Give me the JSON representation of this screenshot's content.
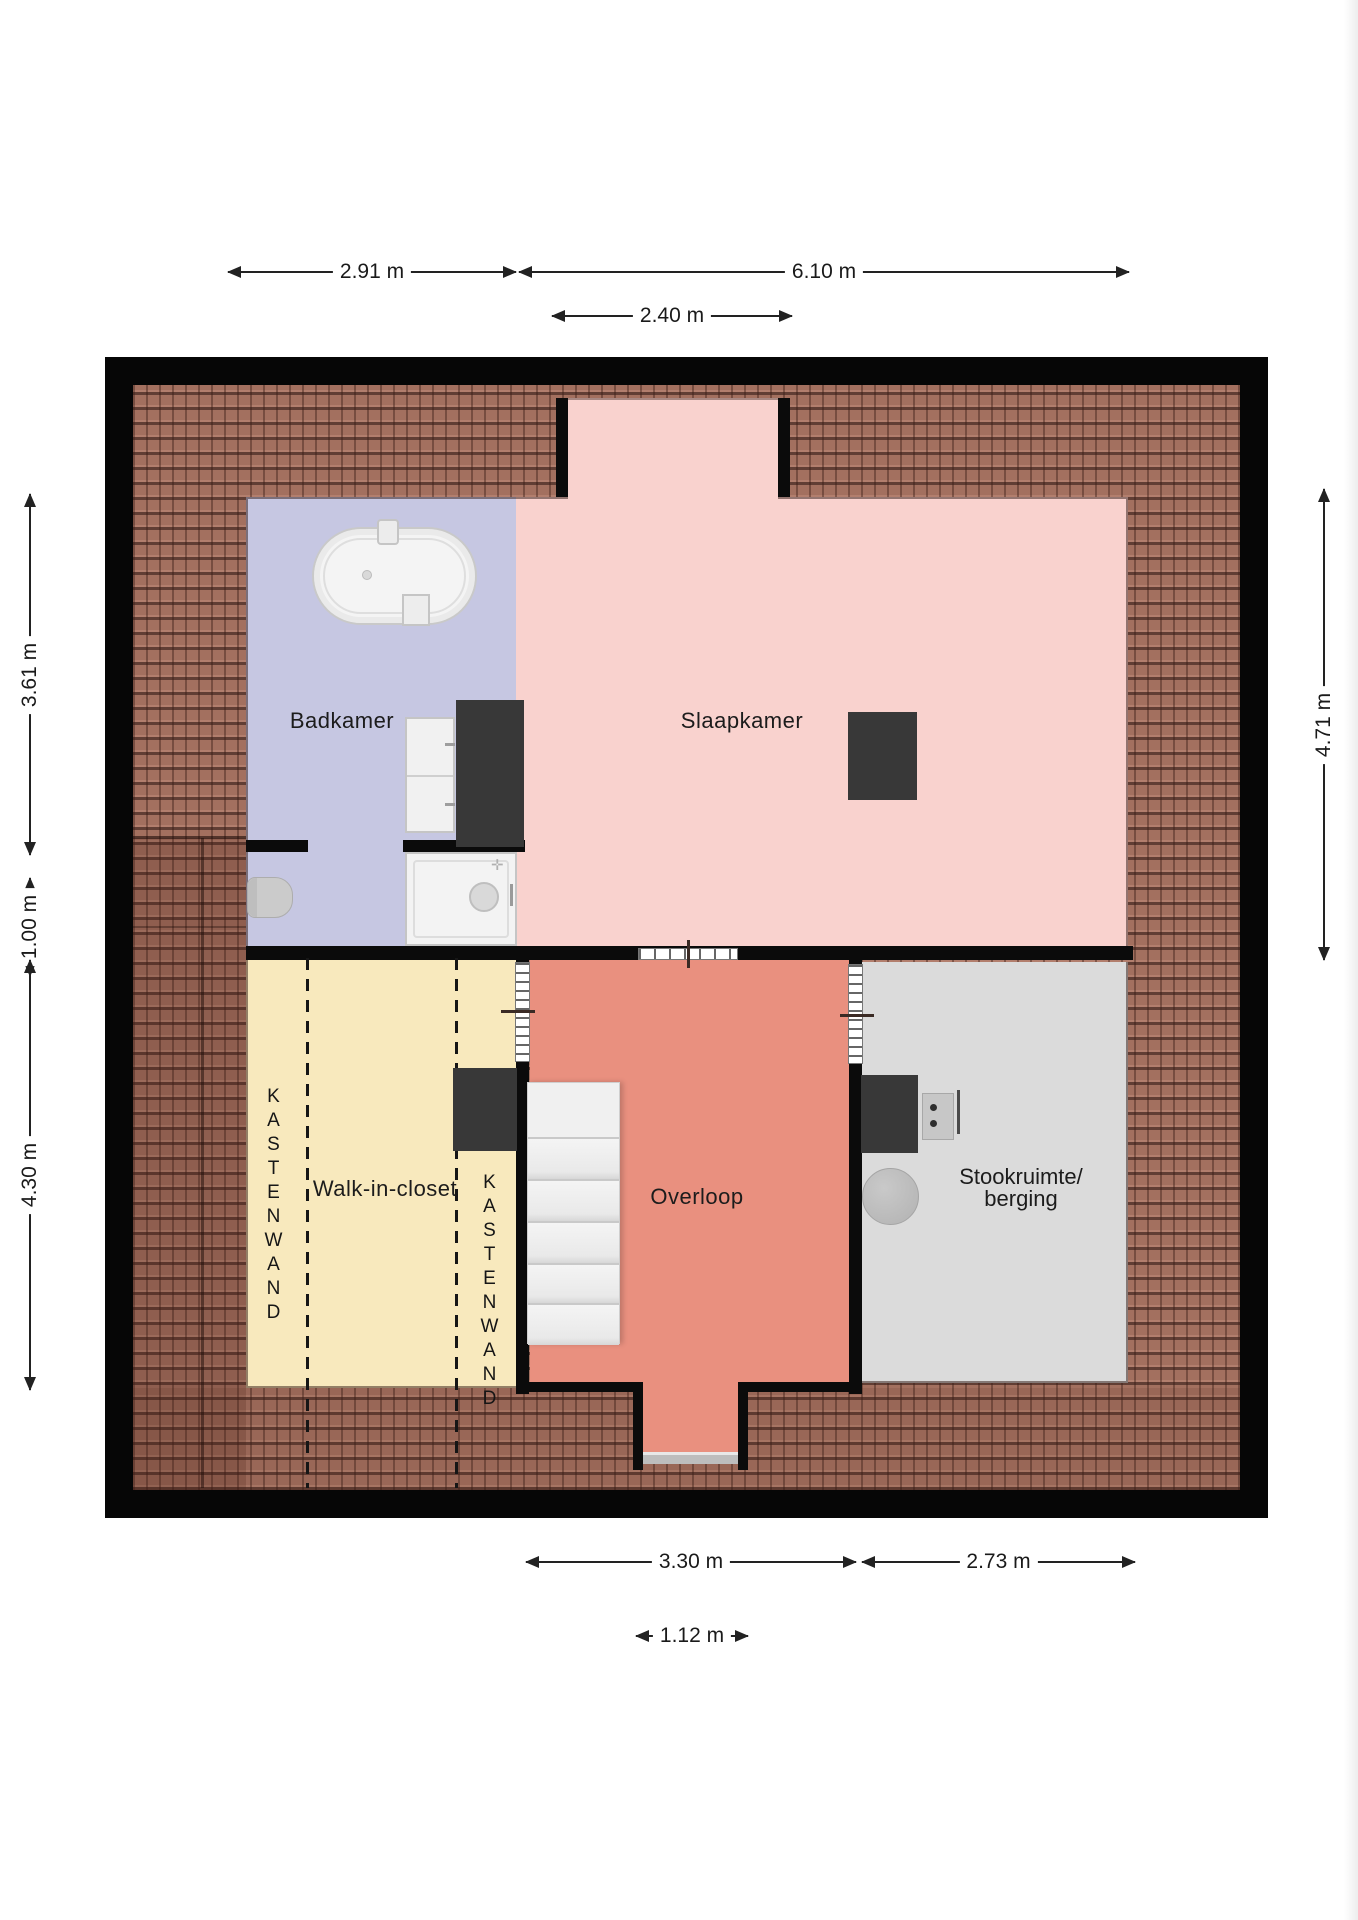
{
  "plan": {
    "type": "floor-plan-top-view",
    "rooms": {
      "badkamer": {
        "label": "Badkamer"
      },
      "slaapkamer": {
        "label": "Slaapkamer"
      },
      "walk_in_closet": {
        "label": "Walk-in-closet",
        "kastenwand_left": "KASTENWAND",
        "kastenwand_right": "KASTENWAND"
      },
      "overloop": {
        "label": "Overloop"
      },
      "stookruimte_berging": {
        "label_line1": "Stookruimte/",
        "label_line2": "berging"
      }
    },
    "dims": {
      "top": [
        {
          "label": "2.91 m",
          "meters": 2.91
        },
        {
          "label": "6.10 m",
          "meters": 6.1
        },
        {
          "label": "2.40 m",
          "meters": 2.4
        }
      ],
      "left": [
        {
          "label": "3.61 m",
          "meters": 3.61
        },
        {
          "label": "1.00 m",
          "meters": 1.0
        },
        {
          "label": "4.30 m",
          "meters": 4.3
        }
      ],
      "right": [
        {
          "label": "4.71 m",
          "meters": 4.71
        }
      ],
      "bottom": [
        {
          "label": "3.30 m",
          "meters": 3.3
        },
        {
          "label": "2.73 m",
          "meters": 2.73
        },
        {
          "label": "1.12 m",
          "meters": 1.12
        }
      ]
    },
    "fixtures": {
      "badkamer": [
        "bathtub",
        "bathtub-faucet",
        "washbasin-cabinet",
        "wardrobe",
        "toilet",
        "shower-tray"
      ],
      "slaapkamer": [
        "cabinet"
      ],
      "walk_in_closet": [
        "cabinet",
        "dashed-closet-wall",
        "dashed-closet-wall"
      ],
      "overloop": [
        "staircase",
        "sliding-door",
        "door-opening",
        "door-opening"
      ],
      "stookruimte_berging": [
        "boiler-unit",
        "control-box",
        "water-heater-tank"
      ]
    },
    "colors": {
      "roof_tile": "#a3705f",
      "wall": "#0b0b0b",
      "badkamer": "#c6c7e2",
      "slaapkamer": "#f9d2ce",
      "walk_in_closet": "#f8e9bd",
      "overloop": "#e9907f",
      "stookruimte": "#dbdbdb",
      "furniture_dark": "#383838",
      "stairs": "#efefef",
      "dim_text": "#1a1a1a"
    }
  }
}
